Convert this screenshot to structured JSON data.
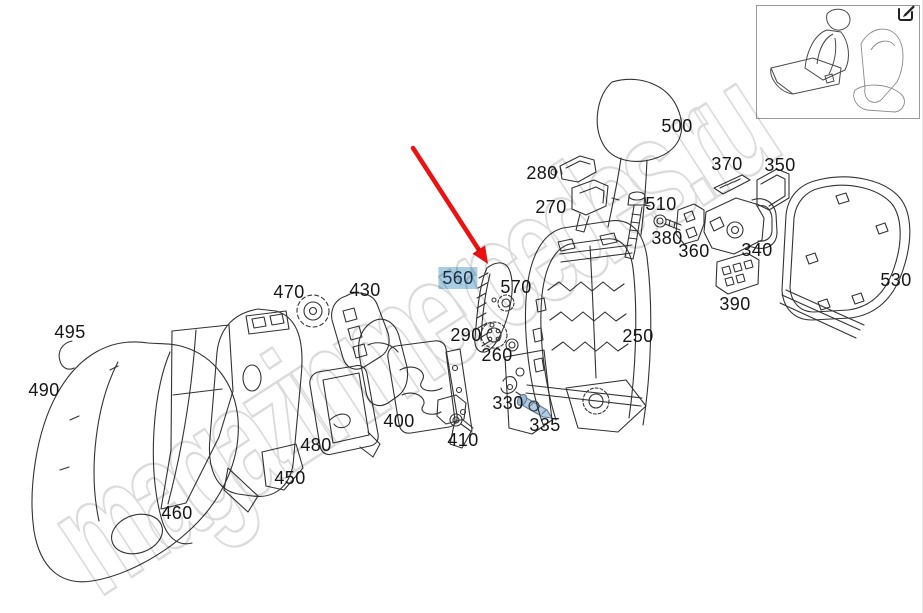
{
  "watermark": {
    "text": "magazinmercedes.ru",
    "color": "#d2d2d2"
  },
  "selection": {
    "selected_part": "560",
    "highlight_bg": "#a9cee3"
  },
  "arrow": {
    "color": "#ee1111",
    "points_to": "560"
  },
  "icons": {
    "edit_external": "pencil-square"
  },
  "thumbnail": {
    "name": "seat-assembly-overview"
  },
  "parts_labels": [
    {
      "text": "500",
      "x": 677,
      "y": 126
    },
    {
      "text": "280",
      "x": 542,
      "y": 173
    },
    {
      "text": "270",
      "x": 551,
      "y": 207
    },
    {
      "text": "510",
      "x": 661,
      "y": 204
    },
    {
      "text": "380",
      "x": 667,
      "y": 238
    },
    {
      "text": "360",
      "x": 694,
      "y": 251
    },
    {
      "text": "370",
      "x": 727,
      "y": 164
    },
    {
      "text": "350",
      "x": 780,
      "y": 165
    },
    {
      "text": "340",
      "x": 757,
      "y": 250
    },
    {
      "text": "390",
      "x": 735,
      "y": 304
    },
    {
      "text": "530",
      "x": 896,
      "y": 280
    },
    {
      "text": "250",
      "x": 638,
      "y": 336
    },
    {
      "text": "560",
      "x": 458,
      "y": 278,
      "highlighted": true
    },
    {
      "text": "570",
      "x": 516,
      "y": 287
    },
    {
      "text": "290",
      "x": 466,
      "y": 335
    },
    {
      "text": "260",
      "x": 497,
      "y": 355
    },
    {
      "text": "330",
      "x": 508,
      "y": 403
    },
    {
      "text": "335",
      "x": 545,
      "y": 425
    },
    {
      "text": "470",
      "x": 289,
      "y": 292
    },
    {
      "text": "430",
      "x": 365,
      "y": 290
    },
    {
      "text": "495",
      "x": 70,
      "y": 332
    },
    {
      "text": "490",
      "x": 44,
      "y": 390
    },
    {
      "text": "480",
      "x": 316,
      "y": 445
    },
    {
      "text": "400",
      "x": 399,
      "y": 421
    },
    {
      "text": "410",
      "x": 463,
      "y": 440
    },
    {
      "text": "450",
      "x": 290,
      "y": 478
    },
    {
      "text": "460",
      "x": 177,
      "y": 513
    }
  ]
}
